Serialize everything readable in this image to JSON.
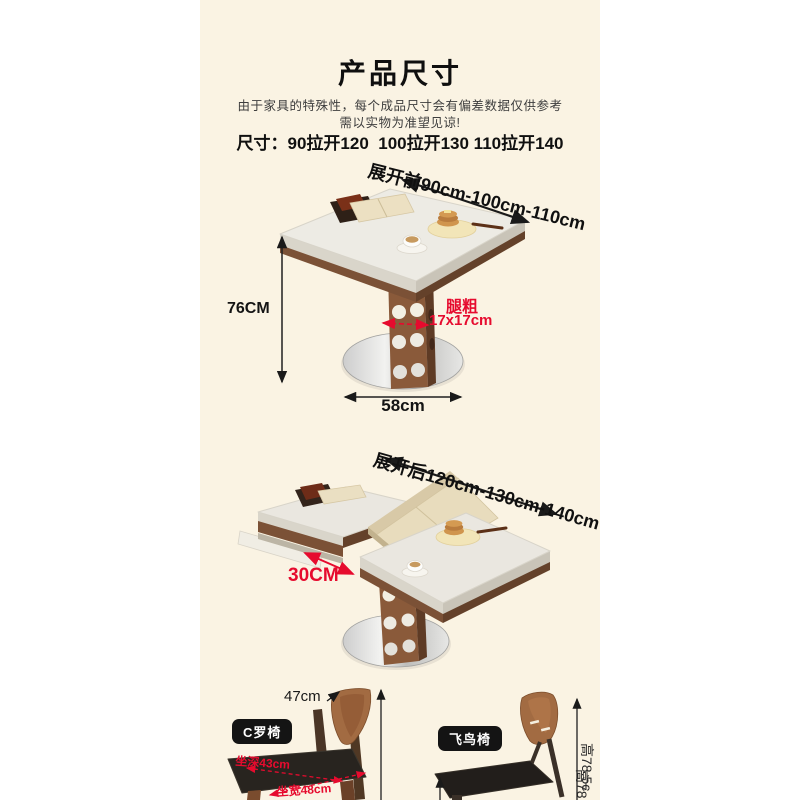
{
  "colors": {
    "page_bg": "#ffffff",
    "panel_bg": "#faf3e3",
    "accent_red": "#e60b2e",
    "text_dark": "#141414",
    "wood": "#8a5a3a",
    "badge_bg": "#141414"
  },
  "header": {
    "title": "产品尺寸",
    "subtitle_line1": "由于家具的特殊性，每个成品尺寸会有偏差数据仅供参考",
    "subtitle_line2": "需以实物为准望见谅!",
    "size_line": "尺寸：90拉开120  100拉开130 110拉开140"
  },
  "table_before": {
    "expand_label": "展开前90cm-100cm-110cm",
    "height_label": "76CM",
    "leg_title": "腿粗",
    "leg_size": "17x17cm",
    "base_width": "58cm"
  },
  "table_after": {
    "expand_label": "展开后120cm-130cm-140cm",
    "extension_label": "30CM"
  },
  "chairs": {
    "left_badge": "C罗椅",
    "left_back_width": "47cm",
    "left_seat_depth": "坐深43cm",
    "left_seat_width": "坐宽48cm",
    "left_height": "高78.5c",
    "right_badge": "飞鸟椅",
    "right_height": "高78"
  }
}
